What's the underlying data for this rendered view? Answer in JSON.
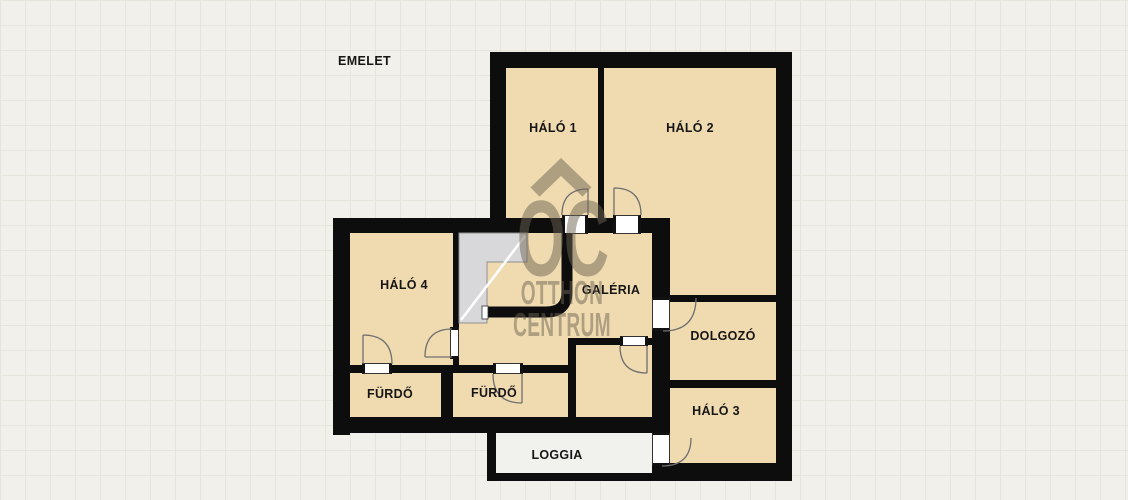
{
  "title": "EMELET",
  "watermark": {
    "logo": "OC",
    "line2": "OTTHON",
    "line3": "CENTRUM"
  },
  "rooms": [
    {
      "name": "HÁLÓ 1"
    },
    {
      "name": "HÁLÓ 2"
    },
    {
      "name": "HÁLÓ 4"
    },
    {
      "name": "GALÉRIA"
    },
    {
      "name": "DOLGOZÓ"
    },
    {
      "name": "FÜRDŐ"
    },
    {
      "name": "FÜRDŐ"
    },
    {
      "name": "HÁLÓ 3"
    },
    {
      "name": "LOGGIA"
    }
  ],
  "colors": {
    "wall": "#0d0d0d",
    "room_floor": "#f0dbb1",
    "loggia_floor": "#f1f1ee",
    "stairs": "#d8d8da",
    "watermark": "#6d6452",
    "background": "#f2f0ea",
    "grid_line": "#e7e4db"
  }
}
